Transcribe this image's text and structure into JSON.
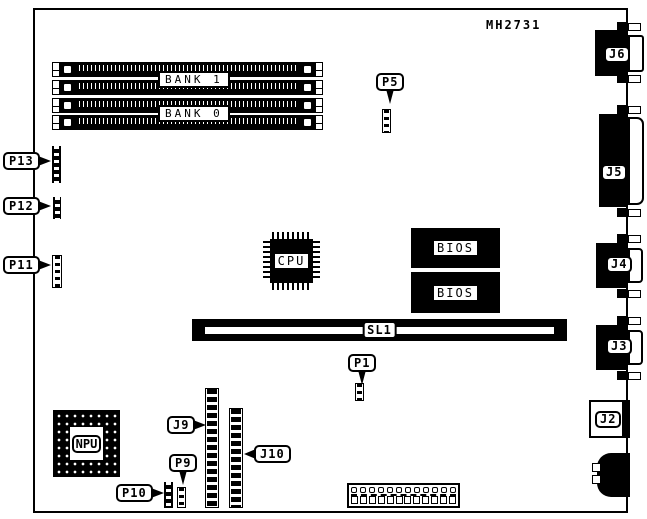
{
  "part_number": "MH2731",
  "colors": {
    "ink": "#000000",
    "paper": "#ffffff"
  },
  "memory": {
    "bank1_label": "BANK 1",
    "bank0_label": "BANK 0",
    "slots_per_bank": 2
  },
  "chips": {
    "cpu_label": "CPU",
    "npu_label": "NPU",
    "bios_top_label": "BIOS",
    "bios_bottom_label": "BIOS"
  },
  "expansion_slot": {
    "label": "SL1"
  },
  "pin_headers": {
    "p1": "P1",
    "p5": "P5",
    "p9": "P9",
    "p10": "P10",
    "p11": "P11",
    "p12": "P12",
    "p13": "P13",
    "j9": "J9",
    "j10": "J10"
  },
  "rear_connectors": {
    "j2": "J2",
    "j3": "J3",
    "j4": "J4",
    "j5": "J5",
    "j6": "J6"
  },
  "terminal_block": {
    "pin_count": 12
  }
}
